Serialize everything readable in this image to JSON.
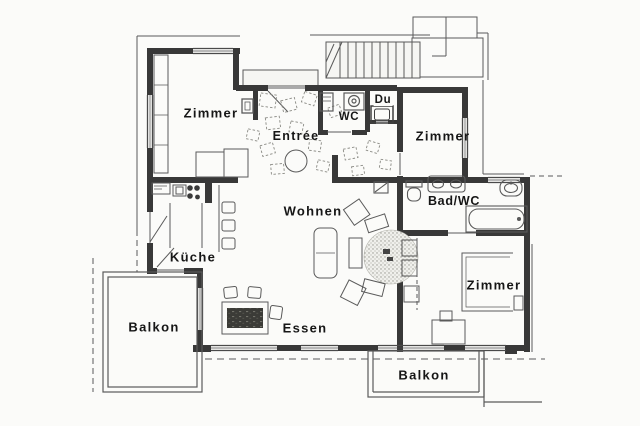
{
  "plan": {
    "type": "apartment-floor-plan",
    "language": "de"
  },
  "labels": {
    "zimmer_top_left": "Zimmer",
    "entree": "Entrée",
    "wc": "WC",
    "du": "Du",
    "zimmer_top_right": "Zimmer",
    "bad_wc": "Bad/WC",
    "wohnen": "Wohnen",
    "kueche": "Küche",
    "balkon_left": "Balkon",
    "essen": "Essen",
    "zimmer_right": "Zimmer",
    "balkon_right": "Balkon"
  },
  "colors": {
    "wall": "#383838",
    "line": "#5a5a5a",
    "text": "#161616",
    "paper": "#fbfbf9"
  }
}
